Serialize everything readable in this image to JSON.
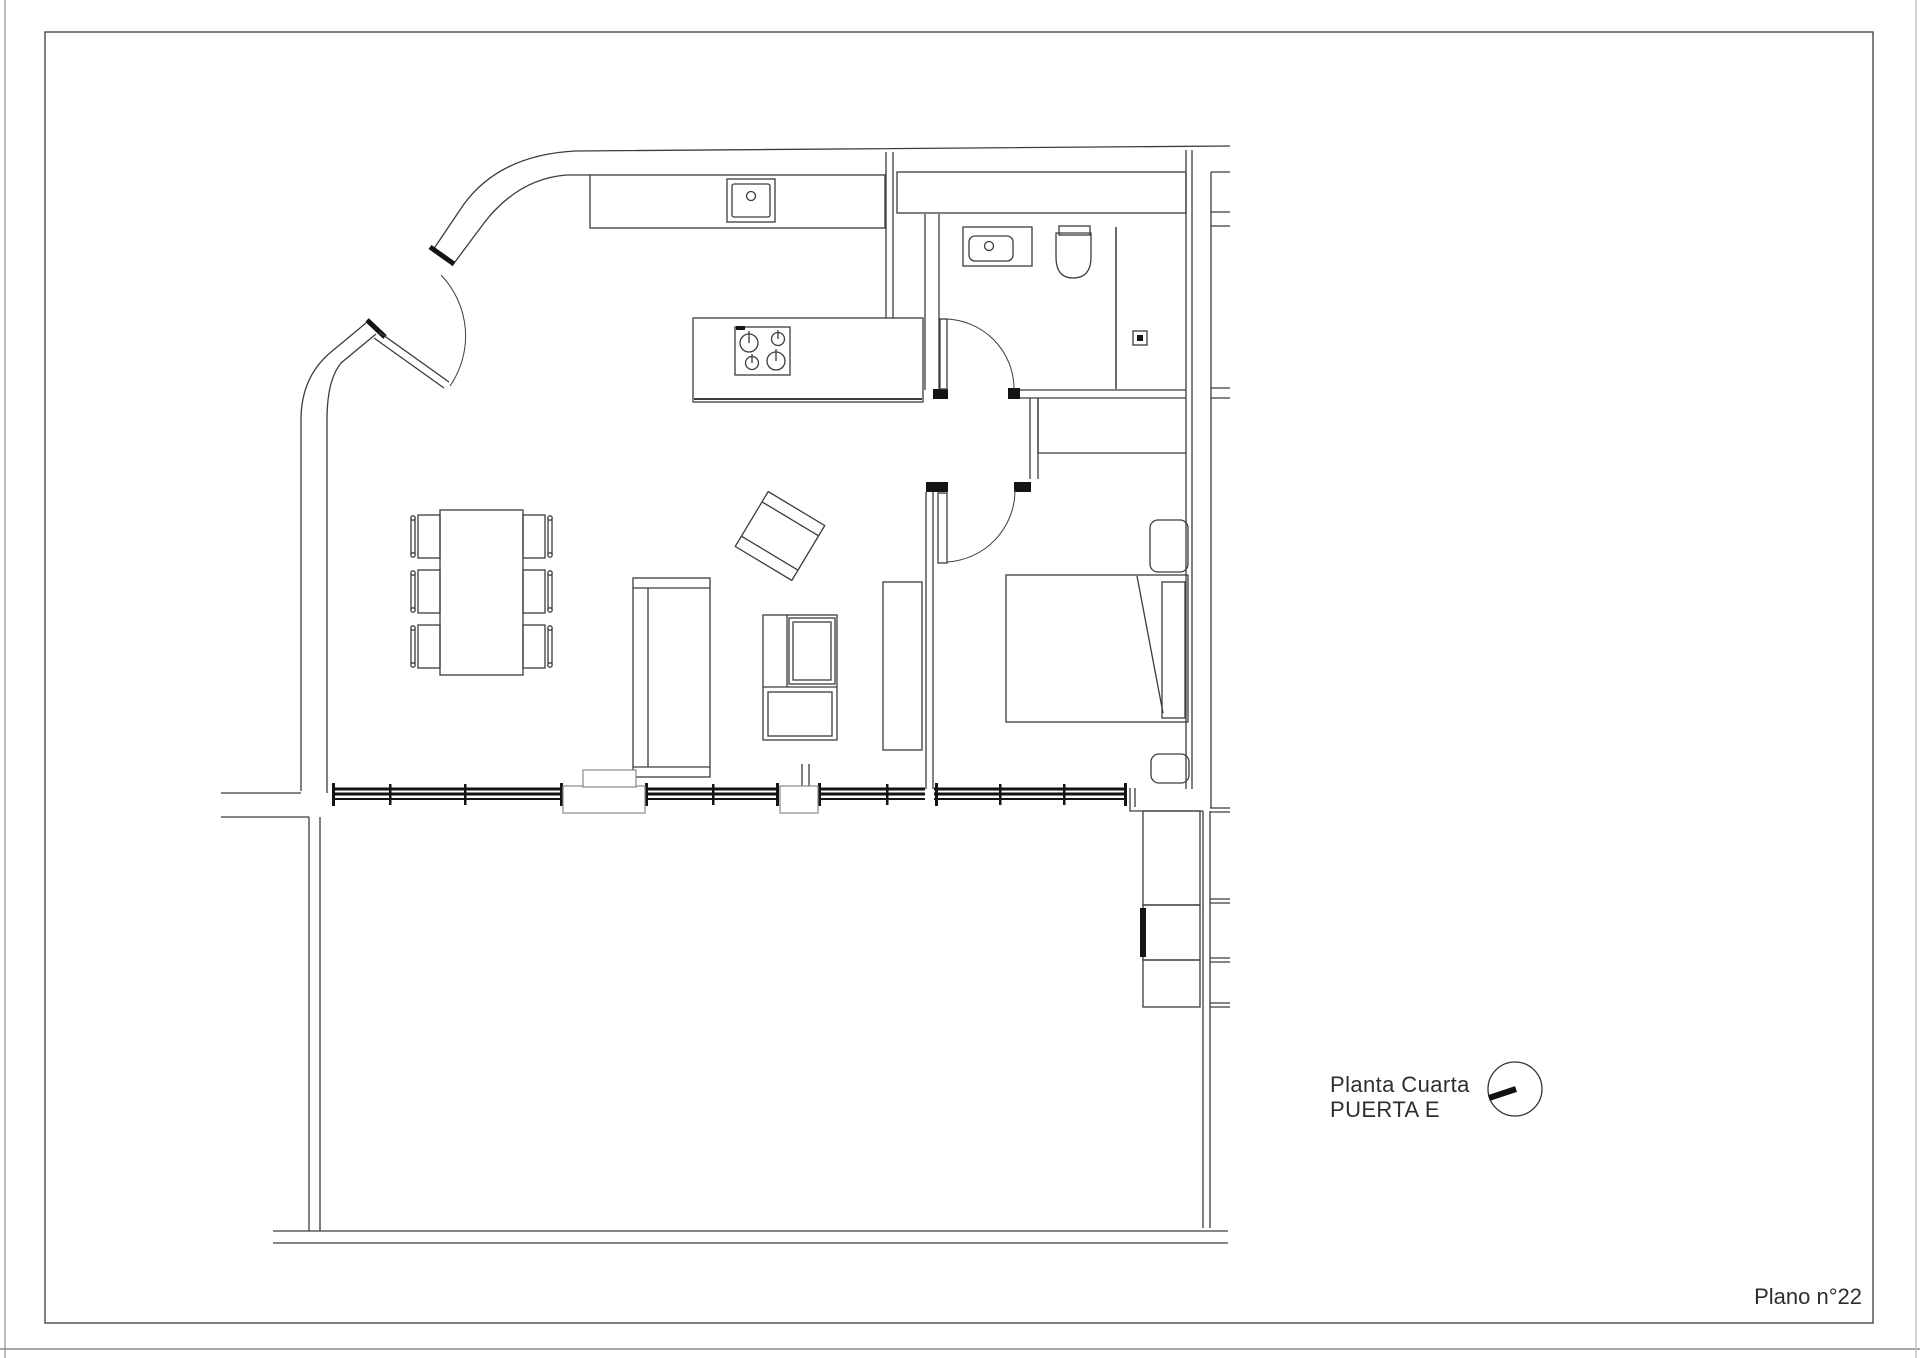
{
  "annotations": {
    "floor_label_line1": "Planta Cuarta",
    "floor_label_line2": "PUERTA E",
    "sheet_number": "Plano n°22"
  },
  "compass": {
    "symbol": "circle-with-needle",
    "needle_direction": "west-southwest"
  },
  "palette": {
    "paper": "#ffffff",
    "wall_line": "#3c3c3c",
    "dark_fill": "#141414",
    "frame": "#4a4a4a",
    "pillar_outline": "#888888",
    "text": "#2e2e2e"
  }
}
